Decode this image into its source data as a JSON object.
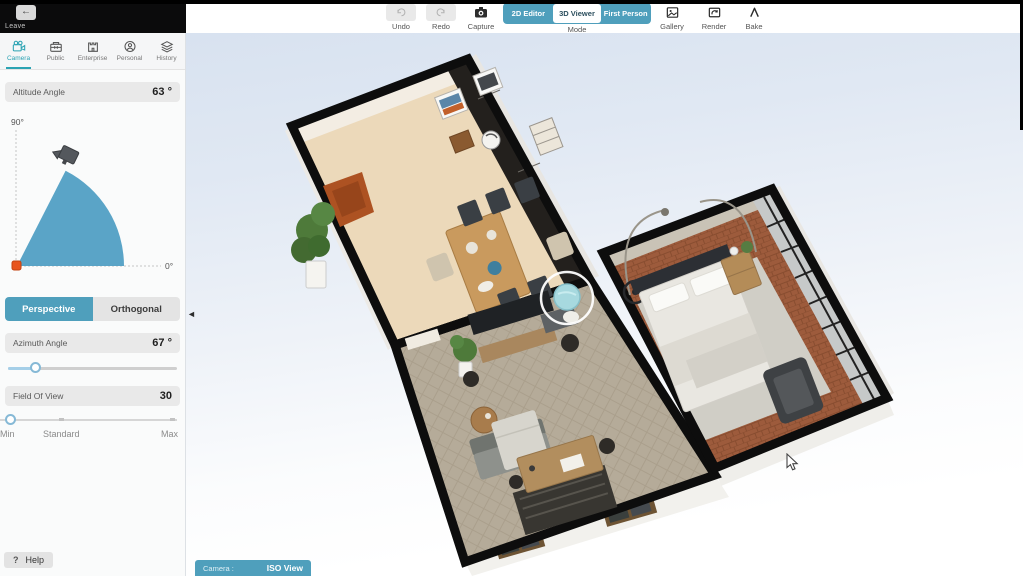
{
  "header": {
    "leave": {
      "icon": "←",
      "label": "Leave"
    },
    "undo_label": "Undo",
    "redo_label": "Redo",
    "capture_label": "Capture",
    "mode": {
      "label": "Mode",
      "options": [
        "2D Editor",
        "3D Viewer",
        "First Person"
      ],
      "selected": "3D Viewer"
    },
    "gallery_label": "Gallery",
    "render_label": "Render",
    "bake_label": "Bake"
  },
  "sidebar": {
    "tabs": [
      {
        "label": "Camera",
        "icon": "video-camera-icon",
        "active": true
      },
      {
        "label": "Public",
        "icon": "box-icon",
        "active": false
      },
      {
        "label": "Enterprise",
        "icon": "castle-icon",
        "active": false
      },
      {
        "label": "Personal",
        "icon": "person-icon",
        "active": false
      },
      {
        "label": "History",
        "icon": "layers-icon",
        "active": false
      }
    ],
    "altitude": {
      "label": "Altitude Angle",
      "value": "63 °"
    },
    "altitude_diagram": {
      "max_label": "90°",
      "min_label": "0°"
    },
    "projection": {
      "options": [
        "Perspective",
        "Orthogonal"
      ],
      "selected": "Perspective"
    },
    "azimuth": {
      "label": "Azimuth Angle",
      "value": "67 °"
    },
    "field_of_view": {
      "label": "Field Of View",
      "value": "30",
      "scale_labels": [
        "Min",
        "Standard",
        "Max"
      ]
    },
    "help": {
      "icon": "?",
      "label": "Help"
    }
  },
  "viewport": {
    "collapse_icon": "◄",
    "camera_bar": {
      "label": "Camera :",
      "value": "ISO View"
    }
  },
  "colors": {
    "accent": "#4f9fbc",
    "tab_active": "#2ba3b3",
    "arc_fill": "#4e9dc3",
    "origin_marker": "#e8551e",
    "wall": "#0d0d0d"
  }
}
